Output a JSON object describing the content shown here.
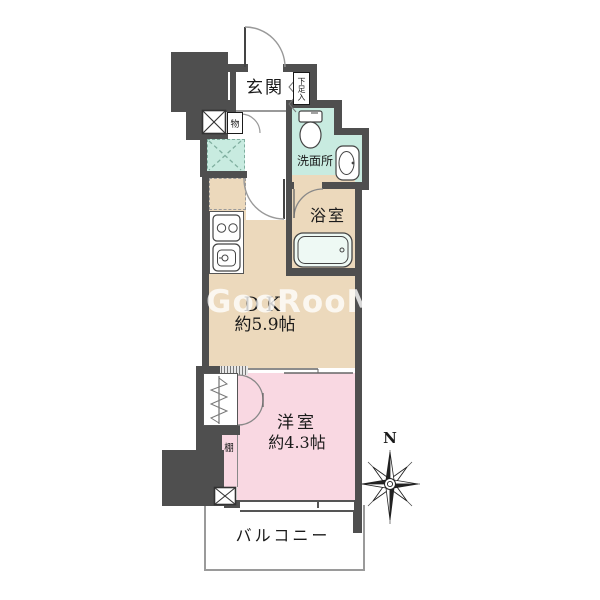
{
  "title": "ワンルーム間取り図",
  "colors": {
    "wall": "#4f4f4f",
    "mint": "#c8ebe0",
    "beige": "#ecd9bc",
    "pink": "#f9d8e2",
    "balcony_line": "#9a9a9a",
    "watermark_color": "rgba(255,255,255,0.78)"
  },
  "labels": {
    "genkan": "玄関",
    "shoe_cabinet": "下足入",
    "storage": "物",
    "washroom": "洗面所",
    "bathroom": "浴室",
    "dk_name": "DK",
    "dk_size": "約5.9帖",
    "bedroom_name": "洋室",
    "bedroom_size": "約4.3帖",
    "shelf": "棚",
    "balcony": "バルコニー"
  },
  "compass": {
    "north_label": "N"
  },
  "watermark": {
    "text": "GooRooM",
    "icon": "bird-icon"
  },
  "icons": [
    "entrance-door-arc",
    "storage-door-arc",
    "hall-dk-door-arc",
    "bath-door-arc",
    "toilet-icon",
    "washbasin-icon",
    "bathtub-icon",
    "stove-icon",
    "kitchen-sink-icon",
    "pipe-space-x-icon",
    "washer-space-x-icon",
    "hanger-rail-icon",
    "folding-door-icon",
    "sliding-door-lines",
    "compass-star-icon",
    "bird-icon",
    "shoebox-door-swing-icon"
  ]
}
